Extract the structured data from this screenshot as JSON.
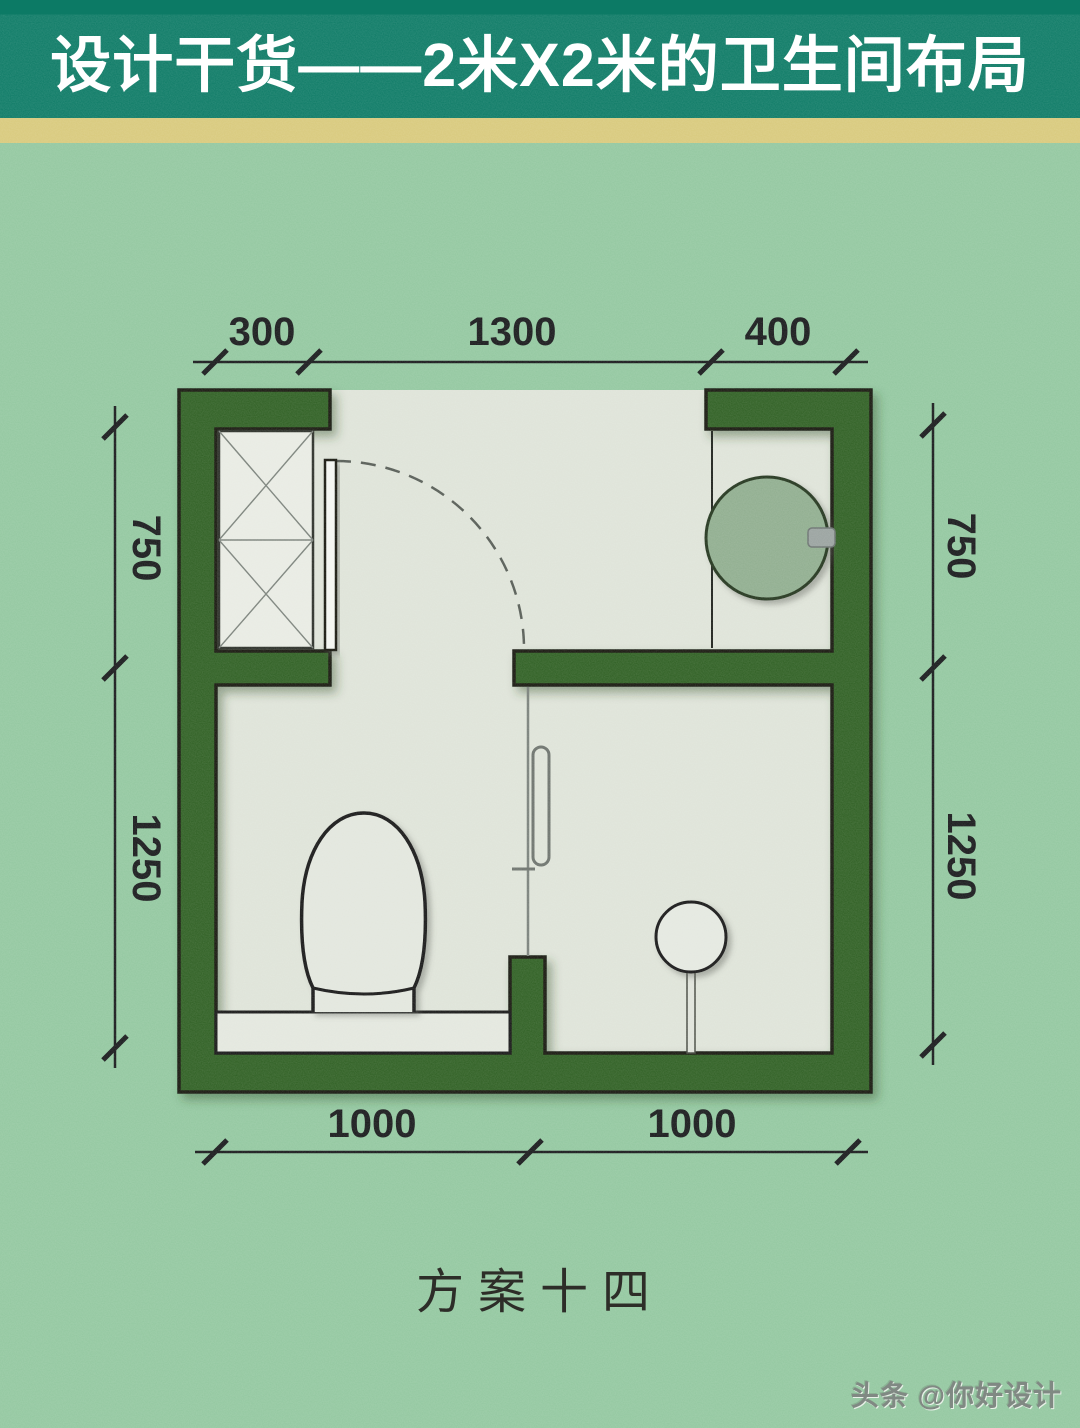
{
  "header": {
    "title": "设计干货——2米X2米的卫生间布局"
  },
  "plan": {
    "dimensions": {
      "top": [
        "300",
        "1300",
        "400"
      ],
      "left": [
        "750",
        "1250"
      ],
      "right": [
        "750",
        "1250"
      ],
      "bottom": [
        "1000",
        "1000"
      ]
    },
    "fixtures": [
      "cabinet",
      "entry-door",
      "washbasin",
      "toilet",
      "shower",
      "glass-partition"
    ]
  },
  "caption": {
    "text": "方案十四"
  },
  "watermark": {
    "text": "头条 @你好设计"
  },
  "colors": {
    "header_bg": "#0c7a65",
    "gold_divider": "#d8c97b",
    "background": "#92c79f",
    "wall": "#2f5e22",
    "floor": "#dee3d8",
    "cabinet_fill": "#e8ebe3",
    "fixture_fill": "#e3e7de",
    "basin": "#8fad8e",
    "outline": "#14180f"
  }
}
